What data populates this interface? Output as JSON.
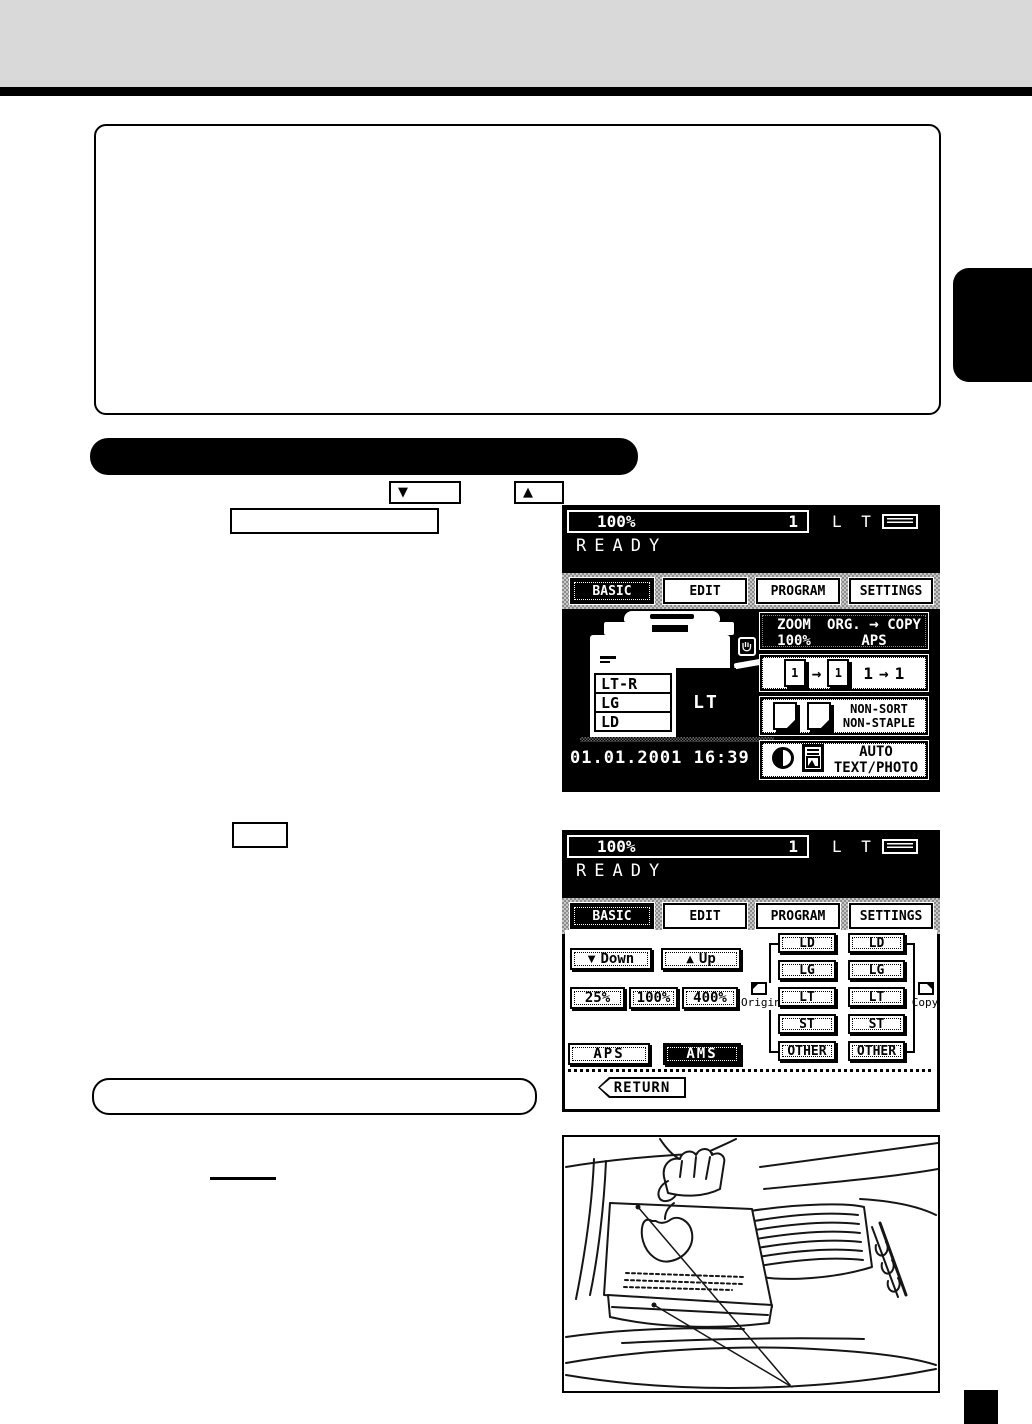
{
  "colors": {
    "band": "#d9d9d9",
    "black": "#000000",
    "white": "#ffffff"
  },
  "icons": {
    "down_triangle": "▼",
    "up_triangle": "▲",
    "right_arrow": "→"
  },
  "note_box": {
    "down_key": "▼",
    "up_key": "▲"
  },
  "lcd1": {
    "status_ratio": "100%",
    "status_count": "1",
    "status_paper": "L T",
    "message": "READY",
    "tabs": [
      "BASIC",
      "EDIT",
      "PROGRAM",
      "SETTINGS"
    ],
    "drawer_sizes": [
      "LT-R",
      "LG",
      "LD"
    ],
    "selected_paper": "LT",
    "zoom_label": "ZOOM",
    "zoom_value": "100%",
    "org_label": "ORG.",
    "copy_label": "COPY",
    "aps_label": "APS",
    "duplex_left": "1",
    "duplex_right": "1",
    "sort_line1": "NON-SORT",
    "sort_line2": "NON-STAPLE",
    "mode_line1": "AUTO",
    "mode_line2": "TEXT/PHOTO",
    "datetime": "01.01.2001 16:39"
  },
  "lcd2": {
    "status_ratio": "100%",
    "status_count": "1",
    "status_paper": "L T",
    "message": "READY",
    "tabs": [
      "BASIC",
      "EDIT",
      "PROGRAM",
      "SETTINGS"
    ],
    "down_label": "Down",
    "up_label": "Up",
    "presets": [
      "25%",
      "100%",
      "400%"
    ],
    "original_label": "Original",
    "copy_side_label": "Copy",
    "original_sizes": [
      "LD",
      "LG",
      "LT",
      "ST",
      "OTHER"
    ],
    "copy_sizes": [
      "LD",
      "LG",
      "LT",
      "ST",
      "OTHER"
    ],
    "aps_label": "APS",
    "ams_label": "AMS",
    "return_label": "RETURN"
  }
}
